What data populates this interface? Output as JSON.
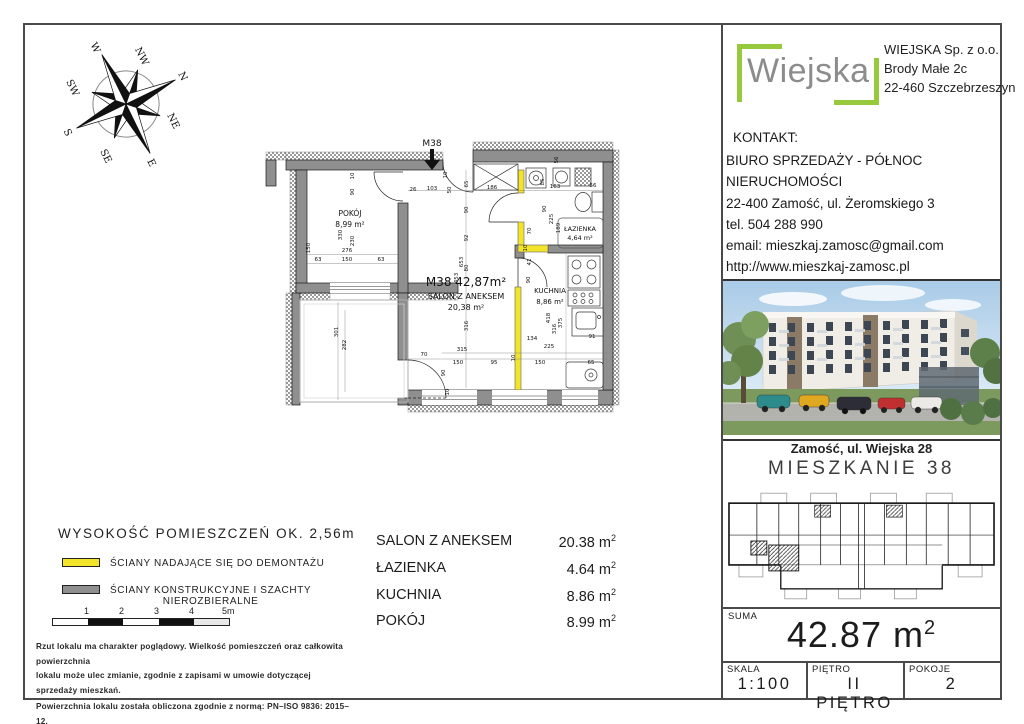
{
  "compass": {
    "labels": {
      "n": "N",
      "ne": "NE",
      "e": "E",
      "se": "SE",
      "s": "S",
      "sw": "SW",
      "w": "W",
      "nw": "NW"
    }
  },
  "plan": {
    "entrance_label": "M38",
    "pokoj": {
      "name": "POKÓJ",
      "area": "8,99 m²"
    },
    "unit_title": "M38  42,87m²",
    "salon": {
      "name": "SALON Z ANEKSEM",
      "area": "20,38 m²"
    },
    "lazienka": {
      "name": "ŁAZIENKA",
      "area": "4,64 m²"
    },
    "kuchnia": {
      "name": "KUCHNIA",
      "area": "8,86 m²"
    },
    "dims": [
      {
        "t": "26",
        "x": 151,
        "y": 61
      },
      {
        "t": "103",
        "x": 170,
        "y": 60
      },
      {
        "t": "186",
        "x": 230,
        "y": 59
      },
      {
        "t": "163",
        "x": 293,
        "y": 58
      },
      {
        "t": "56",
        "x": 331,
        "y": 57
      },
      {
        "t": "63",
        "x": 56,
        "y": 131
      },
      {
        "t": "150",
        "x": 85,
        "y": 131
      },
      {
        "t": "63",
        "x": 119,
        "y": 131
      },
      {
        "t": "276",
        "x": 85,
        "y": 122
      },
      {
        "t": "70",
        "x": 162,
        "y": 226
      },
      {
        "t": "150",
        "x": 196,
        "y": 234
      },
      {
        "t": "95",
        "x": 232,
        "y": 234
      },
      {
        "t": "150",
        "x": 278,
        "y": 234
      },
      {
        "t": "65",
        "x": 329,
        "y": 234
      },
      {
        "t": "315",
        "x": 200,
        "y": 221
      },
      {
        "t": "134",
        "x": 270,
        "y": 210
      },
      {
        "t": "225",
        "x": 287,
        "y": 218
      },
      {
        "t": "91",
        "x": 330,
        "y": 208
      },
      {
        "t": "10",
        "x": 92,
        "y": 46,
        "r": 1
      },
      {
        "t": "90",
        "x": 92,
        "y": 62,
        "r": 1
      },
      {
        "t": "330",
        "x": 80,
        "y": 105,
        "r": 1
      },
      {
        "t": "230",
        "x": 92,
        "y": 111,
        "r": 1
      },
      {
        "t": "150",
        "x": 48,
        "y": 118,
        "r": 1
      },
      {
        "t": "10",
        "x": 185,
        "y": 45,
        "r": 1
      },
      {
        "t": "50",
        "x": 189,
        "y": 60,
        "r": 1
      },
      {
        "t": "65",
        "x": 206,
        "y": 54,
        "r": 1
      },
      {
        "t": "90",
        "x": 206,
        "y": 80,
        "r": 1
      },
      {
        "t": "92",
        "x": 206,
        "y": 108,
        "r": 1
      },
      {
        "t": "80",
        "x": 206,
        "y": 138,
        "r": 1
      },
      {
        "t": "453",
        "x": 196,
        "y": 148,
        "r": 1
      },
      {
        "t": "653",
        "x": 201,
        "y": 132,
        "r": 1
      },
      {
        "t": "316",
        "x": 206,
        "y": 196,
        "r": 1
      },
      {
        "t": "85",
        "x": 282,
        "y": 52,
        "r": 1
      },
      {
        "t": "56",
        "x": 296,
        "y": 30,
        "r": 1
      },
      {
        "t": "90",
        "x": 284,
        "y": 79,
        "r": 1
      },
      {
        "t": "225",
        "x": 291,
        "y": 89,
        "r": 1
      },
      {
        "t": "189",
        "x": 298,
        "y": 98,
        "r": 1
      },
      {
        "t": "70",
        "x": 269,
        "y": 101,
        "r": 1
      },
      {
        "t": "10",
        "x": 265,
        "y": 118,
        "r": 1
      },
      {
        "t": "41",
        "x": 269,
        "y": 132,
        "r": 1
      },
      {
        "t": "90",
        "x": 268,
        "y": 150,
        "r": 1
      },
      {
        "t": "418",
        "x": 288,
        "y": 188,
        "r": 1
      },
      {
        "t": "316",
        "x": 294,
        "y": 199,
        "r": 1
      },
      {
        "t": "375",
        "x": 300,
        "y": 193,
        "r": 1
      },
      {
        "t": "301",
        "x": 76,
        "y": 202,
        "r": 1
      },
      {
        "t": "282",
        "x": 84,
        "y": 215,
        "r": 1
      },
      {
        "t": "90",
        "x": 183,
        "y": 243,
        "r": 1
      },
      {
        "t": "10",
        "x": 187,
        "y": 262,
        "r": 1
      },
      {
        "t": "10",
        "x": 253,
        "y": 228,
        "r": 1
      }
    ]
  },
  "legend": {
    "height_note": "WYSOKOŚĆ POMIESZCZEŃ OK. 2,56m",
    "demountable": "ŚCIANY NADAJĄCE SIĘ DO DEMONTAŻU",
    "structural_1": "ŚCIANY KONSTRUKCYJNE I SZACHTY",
    "structural_2": "NIEROZBIERALNE",
    "scale_ticks": [
      "1",
      "2",
      "3",
      "4",
      "5m"
    ],
    "colors": {
      "demountable": "#f2e32b",
      "structural": "#8f8f8f"
    }
  },
  "rooms_table": {
    "rows": [
      {
        "name": "SALON Z ANEKSEM",
        "area": "20.38 m",
        "sup": "2"
      },
      {
        "name": "ŁAZIENKA",
        "area": "4.64 m",
        "sup": "2"
      },
      {
        "name": "KUCHNIA",
        "area": "8.86 m",
        "sup": "2"
      },
      {
        "name": "POKÓJ",
        "area": "8.99 m",
        "sup": "2"
      }
    ]
  },
  "disclaimer": {
    "lines": [
      "Rzut lokalu ma charakter poglądowy. Wielkość pomieszczeń oraz całkowita powierzchnia",
      "lokalu może ulec zmianie, zgodnie z zapisami w umowie dotyczącej sprzedaży mieszkań.",
      "Powierzchnia lokalu została obliczona zgodnie z normą: PN–ISO 9836: 2015–12.",
      "Wymiary zostały podane w stanie surowym bez tynku."
    ]
  },
  "sidebar": {
    "logo": {
      "text": "Wiejska",
      "accent": "#97c93d"
    },
    "company": {
      "lines": [
        "WIEJSKA Sp. z o.o.",
        "Brody Małe 2c",
        "22-460 Szczebrzeszyn"
      ]
    },
    "contact": {
      "heading": "KONTAKT:",
      "lines": [
        "BIURO SPRZEDAŻY - PÓŁNOC NIERUCHOMOŚCI",
        "22-400 Zamość, ul. Żeromskiego 3",
        "tel. 504 288 990",
        "email: mieszkaj.zamosc@gmail.com",
        "http://www.mieszkaj-zamosc.pl"
      ]
    },
    "photo_caption": "Zamość, ul. Wiejska 28",
    "unit_heading": "MIESZKANIE  38",
    "summary": {
      "label": "SUMA",
      "value": "42.87 m",
      "sup": "2"
    },
    "footer": {
      "scale_label": "SKALA",
      "scale": "1:100",
      "floor_label": "PIĘTRO",
      "floor": "II  PIĘTRO",
      "rooms_label": "POKOJE",
      "rooms": "2"
    }
  }
}
